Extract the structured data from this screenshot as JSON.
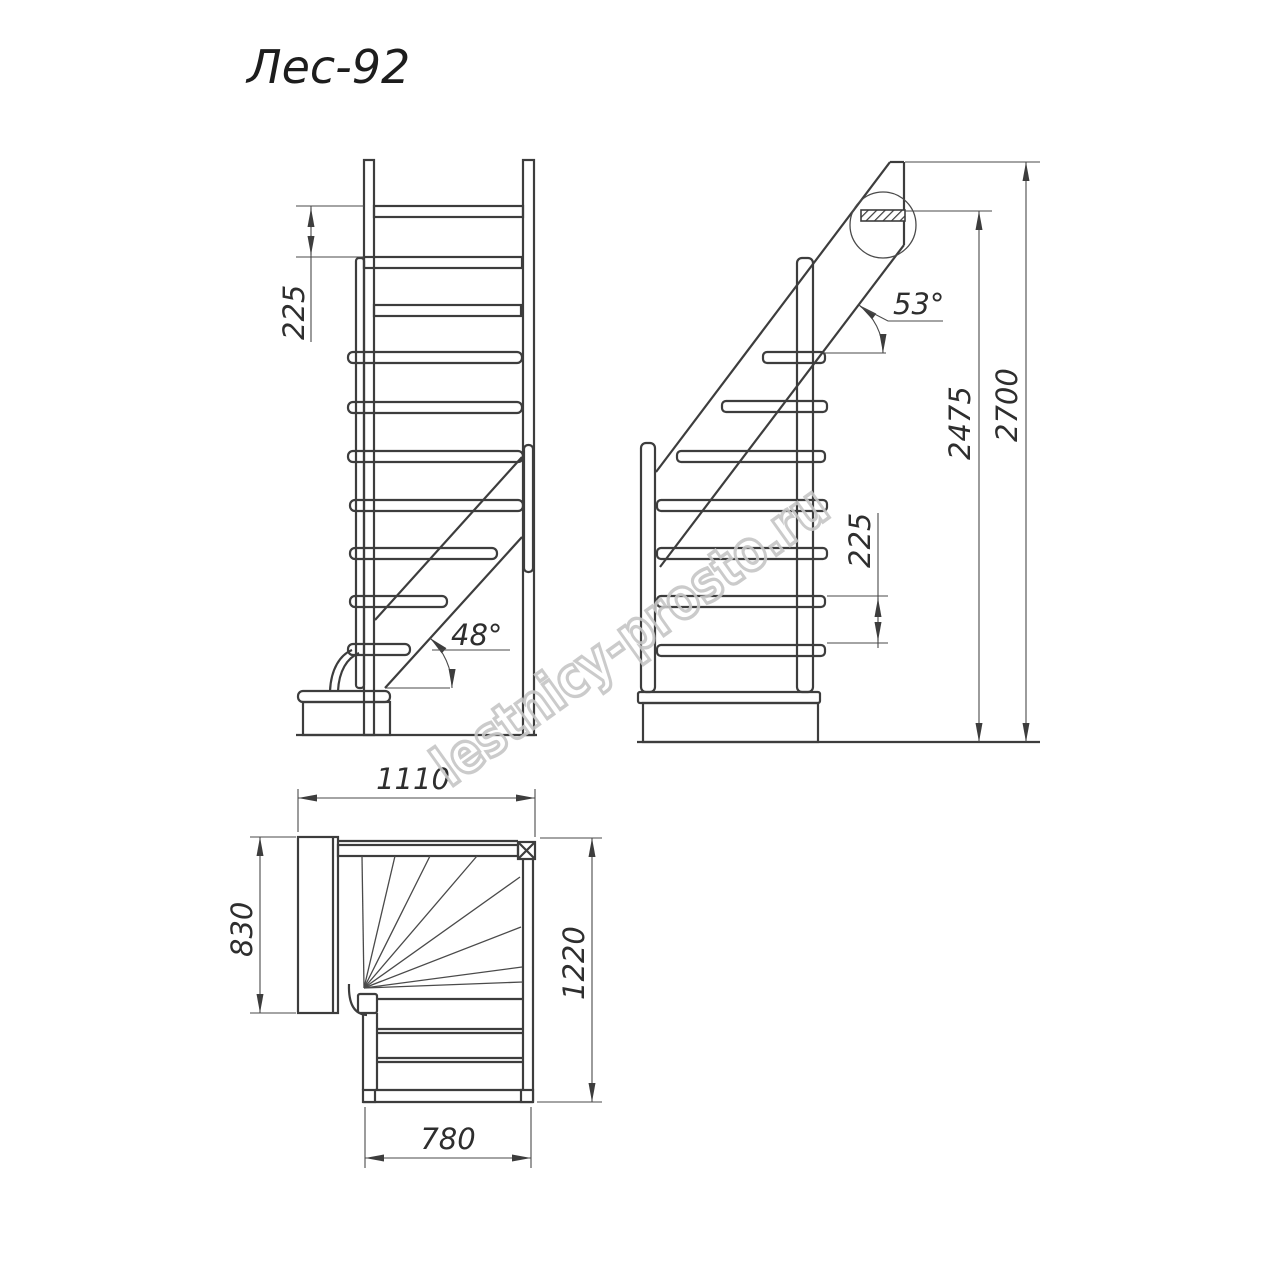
{
  "title": "Лес-92",
  "watermark": "lestnicy-prosto.ru",
  "front_view": {
    "step_rise_mm": "225",
    "stringer_angle": "48°"
  },
  "side_view": {
    "step_rise_mm": "225",
    "stringer_angle": "53°",
    "floor_to_top_step_mm": "2475",
    "total_height_mm": "2700"
  },
  "plan_view": {
    "overall_width_mm": "1110",
    "upper_landing_depth_mm": "830",
    "overall_depth_mm": "1220",
    "flight_width_mm": "780"
  },
  "colors": {
    "line": "#3d3d3d",
    "thin_line": "#4a4a4a",
    "text": "#2e2e2e",
    "watermark": "#c6c6c6",
    "background": "#ffffff"
  }
}
